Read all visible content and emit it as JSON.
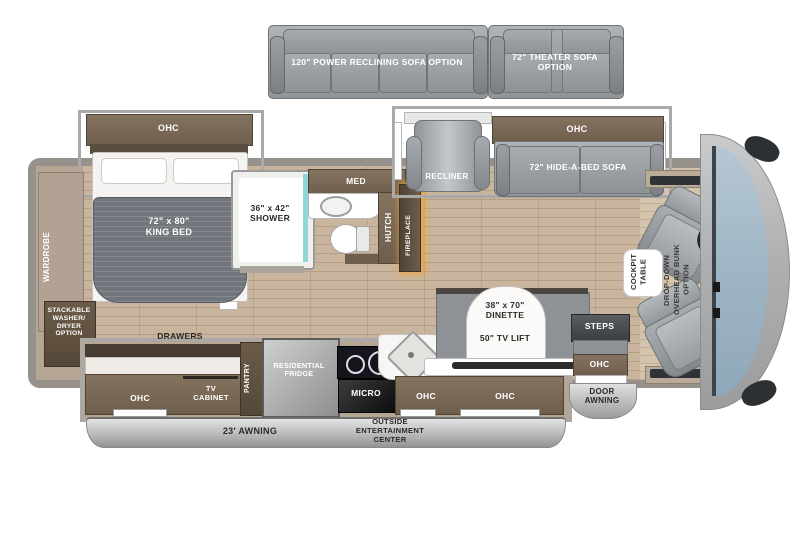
{
  "options_row": {
    "power_sofa_label": "120\" POWER RECLINING SOFA OPTION",
    "theater_sofa_label": "72\" THEATER SOFA\nOPTION"
  },
  "bedroom": {
    "ohc_label": "OHC",
    "king_bed_label": "72\" x 80\"\nKING BED",
    "wardrobe_label": "WARDROBE",
    "washer_dryer_label": "STACKABLE\nWASHER/\nDRYER\nOPTION",
    "drawers_label": "DRAWERS",
    "ohc_cabinet_label": "OHC",
    "tv_cabinet_label": "TV\nCABINET"
  },
  "bathroom": {
    "shower_label": "36\" x 42\"\nSHOWER",
    "med_label": "MED",
    "hutch_label": "HUTCH",
    "fireplace_label": "FIREPLACE"
  },
  "living": {
    "recliner_label": "RECLINER",
    "ohc_label": "OHC",
    "sofa_label": "72\" HIDE-A-BED SOFA"
  },
  "kitchen": {
    "pantry_label": "PANTRY",
    "fridge_label": "RESIDENTIAL\nFRIDGE",
    "micro_label": "MICRO",
    "ohc_mid_label": "OHC",
    "ohc_right_label": "OHC",
    "dinette_label": "38\" x 70\"\nDINETTE",
    "tv_lift_label": "50\" TV LIFT"
  },
  "entry": {
    "steps_label": "STEPS",
    "ohc_label": "OHC",
    "door_awning_label": "DOOR\nAWNING"
  },
  "cockpit": {
    "table_label": "COCKPIT\nTABLE",
    "bunk_label": "DROP-DOWN\nOVERHEAD BUNK\nOPTION"
  },
  "exterior": {
    "awning_label": "23' AWNING",
    "entertainment_label": "OUTSIDE\nENTERTAINMENT\nCENTER"
  },
  "colors": {
    "cabinet_brown": "#6e5e4c",
    "floor_tan": "#c9b59d",
    "sofa_gray": "#9aa0a5",
    "fireplace_glow": "#f2a339",
    "windshield_blue": "#a9bdca"
  }
}
